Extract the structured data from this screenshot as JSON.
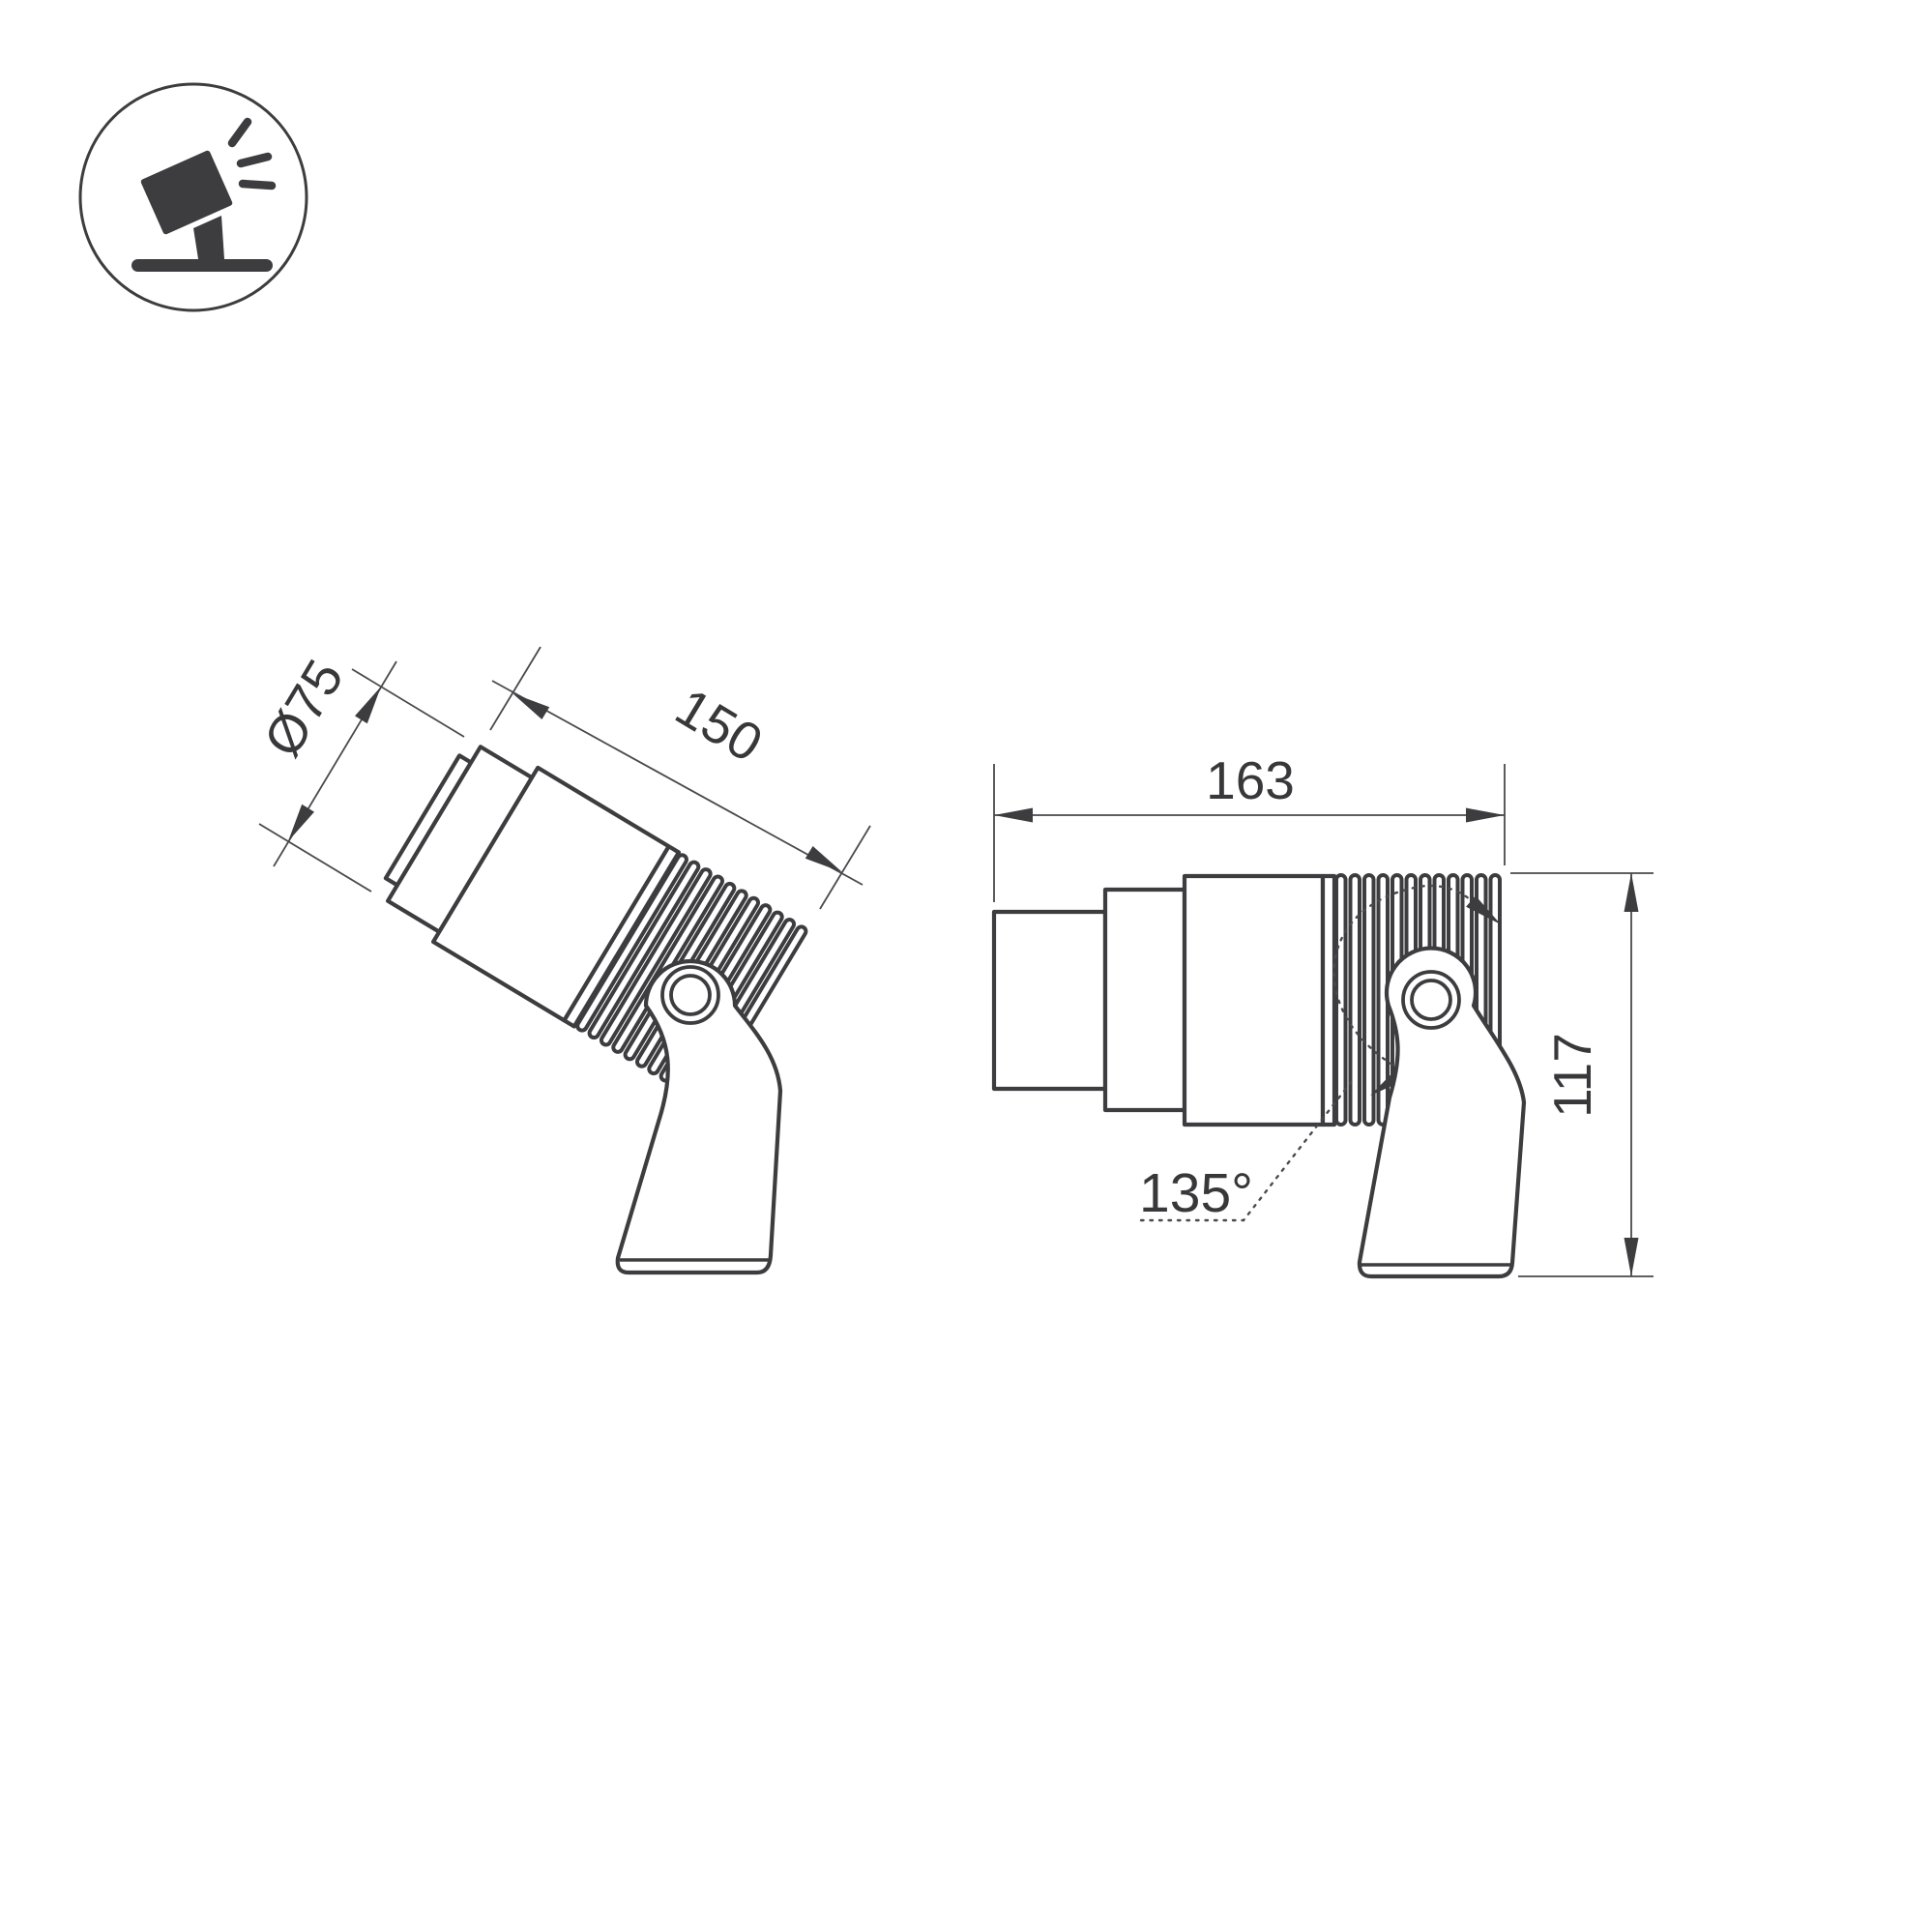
{
  "page": {
    "background": "#ffffff",
    "line_color": "#3d3d40",
    "text_color": "#38383a",
    "description": "Technical dimension drawing of an adjustable LED spotlight on a mounting bracket, two side views plus product pictogram"
  },
  "icon": {
    "name": "tilted-spotlight-on-stand-icon"
  },
  "tilted_view": {
    "diameter_label": "Ø75",
    "length_label": "150"
  },
  "side_view": {
    "total_length_label": "163",
    "height_label": "117",
    "rotation_angle_label": "135°"
  }
}
